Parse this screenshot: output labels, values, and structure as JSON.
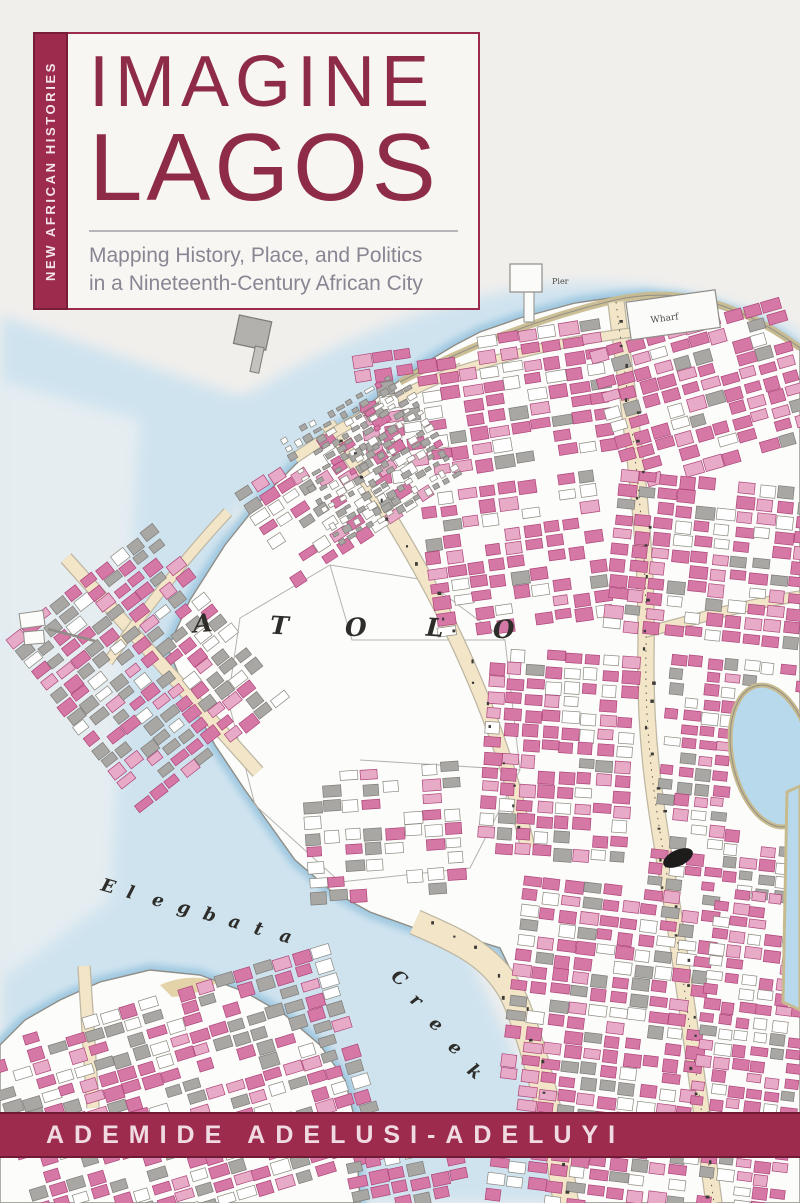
{
  "cover": {
    "series_label": "NEW AFRICAN HISTORIES",
    "title_line1": "IMAGINE",
    "title_line2": "LAGOS",
    "subtitle_line1": "Mapping History, Place, and Politics",
    "subtitle_line2": "in a Nineteenth-Century African City",
    "author": "ADEMIDE ADELUSI-ADELUYI"
  },
  "map": {
    "water_label_word1": "Elegbata",
    "water_label_word2": "Creek",
    "district_letters": [
      "A",
      "T",
      "O",
      "L",
      "O"
    ],
    "pier_label": "Pier",
    "wharf_label": "Wharf"
  },
  "colors": {
    "maroon": "#9c2b4e",
    "maroon_dark": "#701b36",
    "title_maroon": "#8e2b47",
    "subtitle_gray": "#8b8492",
    "paper": "#f1efec",
    "water": "#cfe3ef",
    "water_deep": "#b7d9eb",
    "land": "#fcfcfa",
    "road": "#f3e6c8",
    "road_edge": "#bdb6a2",
    "shore_tan": "#c8ba8f",
    "pink": "#d678a6",
    "pink_light": "#e7aac7",
    "pink_dark": "#ad4579",
    "gray_bldg": "#a9a7a4",
    "gray_bldg_dark": "#7e7c79",
    "outline": "#8f8d86",
    "map_text": "#2e2d2a"
  }
}
